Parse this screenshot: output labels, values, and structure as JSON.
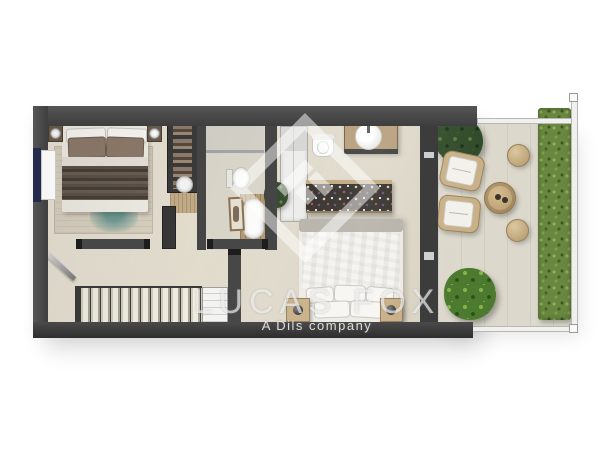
{
  "watermark": {
    "brand": "LUCAS FOX",
    "tagline": "A Dils company",
    "logo": "diamond-monogram"
  },
  "palette": {
    "background": "#ffffff",
    "walls": "#464646",
    "interior_floor": "#e4dfd1",
    "terrace_floor": "#dcd8cc",
    "hedge_green": "#69873f",
    "plant_green": "#4c7a2e",
    "wood": "#c0a67c",
    "rug_accent_teal": "#6f9a92",
    "window_glass": "#232a4d",
    "bedding_white": "#f2f1ed",
    "throw_brown": "#564c43"
  },
  "floor_plan": {
    "type": "apartment-floor-plan-render",
    "rooms": [
      {
        "name": "bedroom-1",
        "items": [
          "double-bed",
          "two-nightstands-with-lamps",
          "area-rug",
          "open-wardrobe",
          "window"
        ]
      },
      {
        "name": "bathroom-1",
        "items": [
          "shower-screen",
          "toilet",
          "freestanding-tub-on-wood-deck",
          "artwork"
        ]
      },
      {
        "name": "hallway",
        "items": [
          "entry-door",
          "staircase",
          "storage-cabinet"
        ]
      },
      {
        "name": "bathroom-2",
        "items": [
          "round-basin-vanity",
          "toilet",
          "white-wardrobe"
        ]
      },
      {
        "name": "bedroom-2",
        "items": [
          "double-bed",
          "two-nightstands-with-lamps",
          "dresser-with-accessories",
          "potted-plant",
          "footboard-bench",
          "glazed-terrace-door"
        ]
      },
      {
        "name": "terrace",
        "items": [
          "potted-tree",
          "two-lounge-chairs",
          "round-coffee-table",
          "two-poufs",
          "palm-plant",
          "hedge",
          "glass-railing"
        ]
      }
    ]
  }
}
